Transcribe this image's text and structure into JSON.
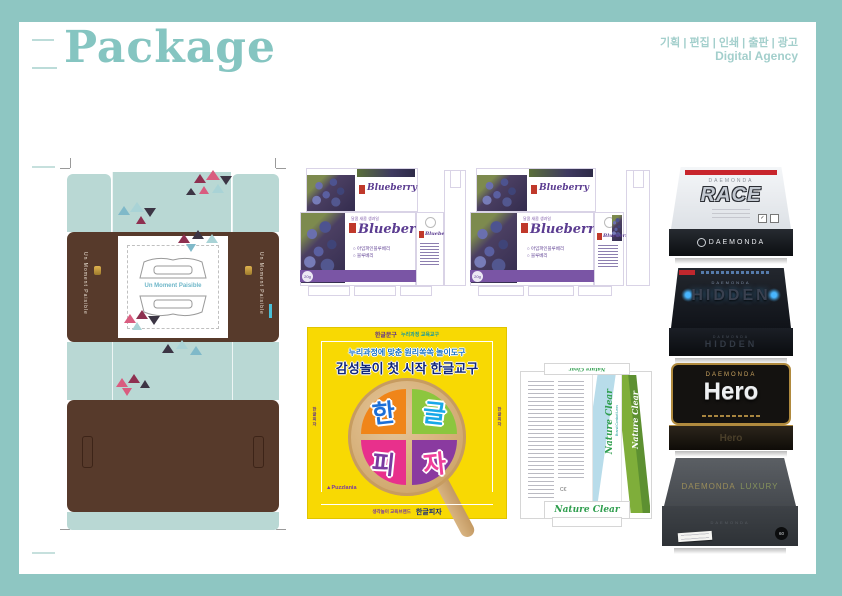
{
  "page": {
    "title": "Package",
    "services": "기획 | 편집 | 인쇄 | 출판 | 광고",
    "agency": "Digital Agency",
    "frame_color": "#8ec6c2",
    "title_color": "#85c5c1"
  },
  "moment": {
    "brand": "Un Moment Paisible",
    "side_text": "Un Moment Paisible",
    "colors": {
      "mint": "#b9d8d4",
      "brown": "#573a2b",
      "triangle_pink": "#d95c7f",
      "triangle_maroon": "#8e3050",
      "triangle_dark": "#3c3544",
      "triangle_teal": "#a9d3d6"
    }
  },
  "blueberry": {
    "tagline": "달콤 새콤 생과일",
    "title": "Blueberry",
    "bullets": [
      "아임파인블루베리",
      "블루베리"
    ],
    "weight": "20g",
    "band_color": "#7a55a5"
  },
  "pizza": {
    "top_brand": "한글문구",
    "top_note": "누리과정 교육교구",
    "subtitle": "누리과정에 맞춘 원리쏙쏙 놀이도구",
    "headline": "감성놀이 첫 시작 한글교구",
    "syllables": [
      "한",
      "글",
      "피",
      "자"
    ],
    "logo": "Puzzlania",
    "bottom_note": "생각놀이 교육브랜드",
    "bottom_title": "한글피자",
    "side_text": "한글피자",
    "yellow": "#f8d903"
  },
  "nature": {
    "title": "Nature Clear",
    "subtitle": "Brand Contact Lens",
    "green": "#2f9e4e"
  },
  "boxes": [
    {
      "brand": "DAEMONDA",
      "title": "RACE",
      "front_label": "DAEMONDA"
    },
    {
      "brand": "DAEMONDA",
      "title": "HIDDEN",
      "front_label": "HIDDEN"
    },
    {
      "brand": "DAEMONDA",
      "title": "Hero",
      "front_label": "Hero"
    },
    {
      "brand": "DAEMONDA",
      "title": "LUXURY",
      "front_label": "LUXURY",
      "badge": "60"
    }
  ]
}
